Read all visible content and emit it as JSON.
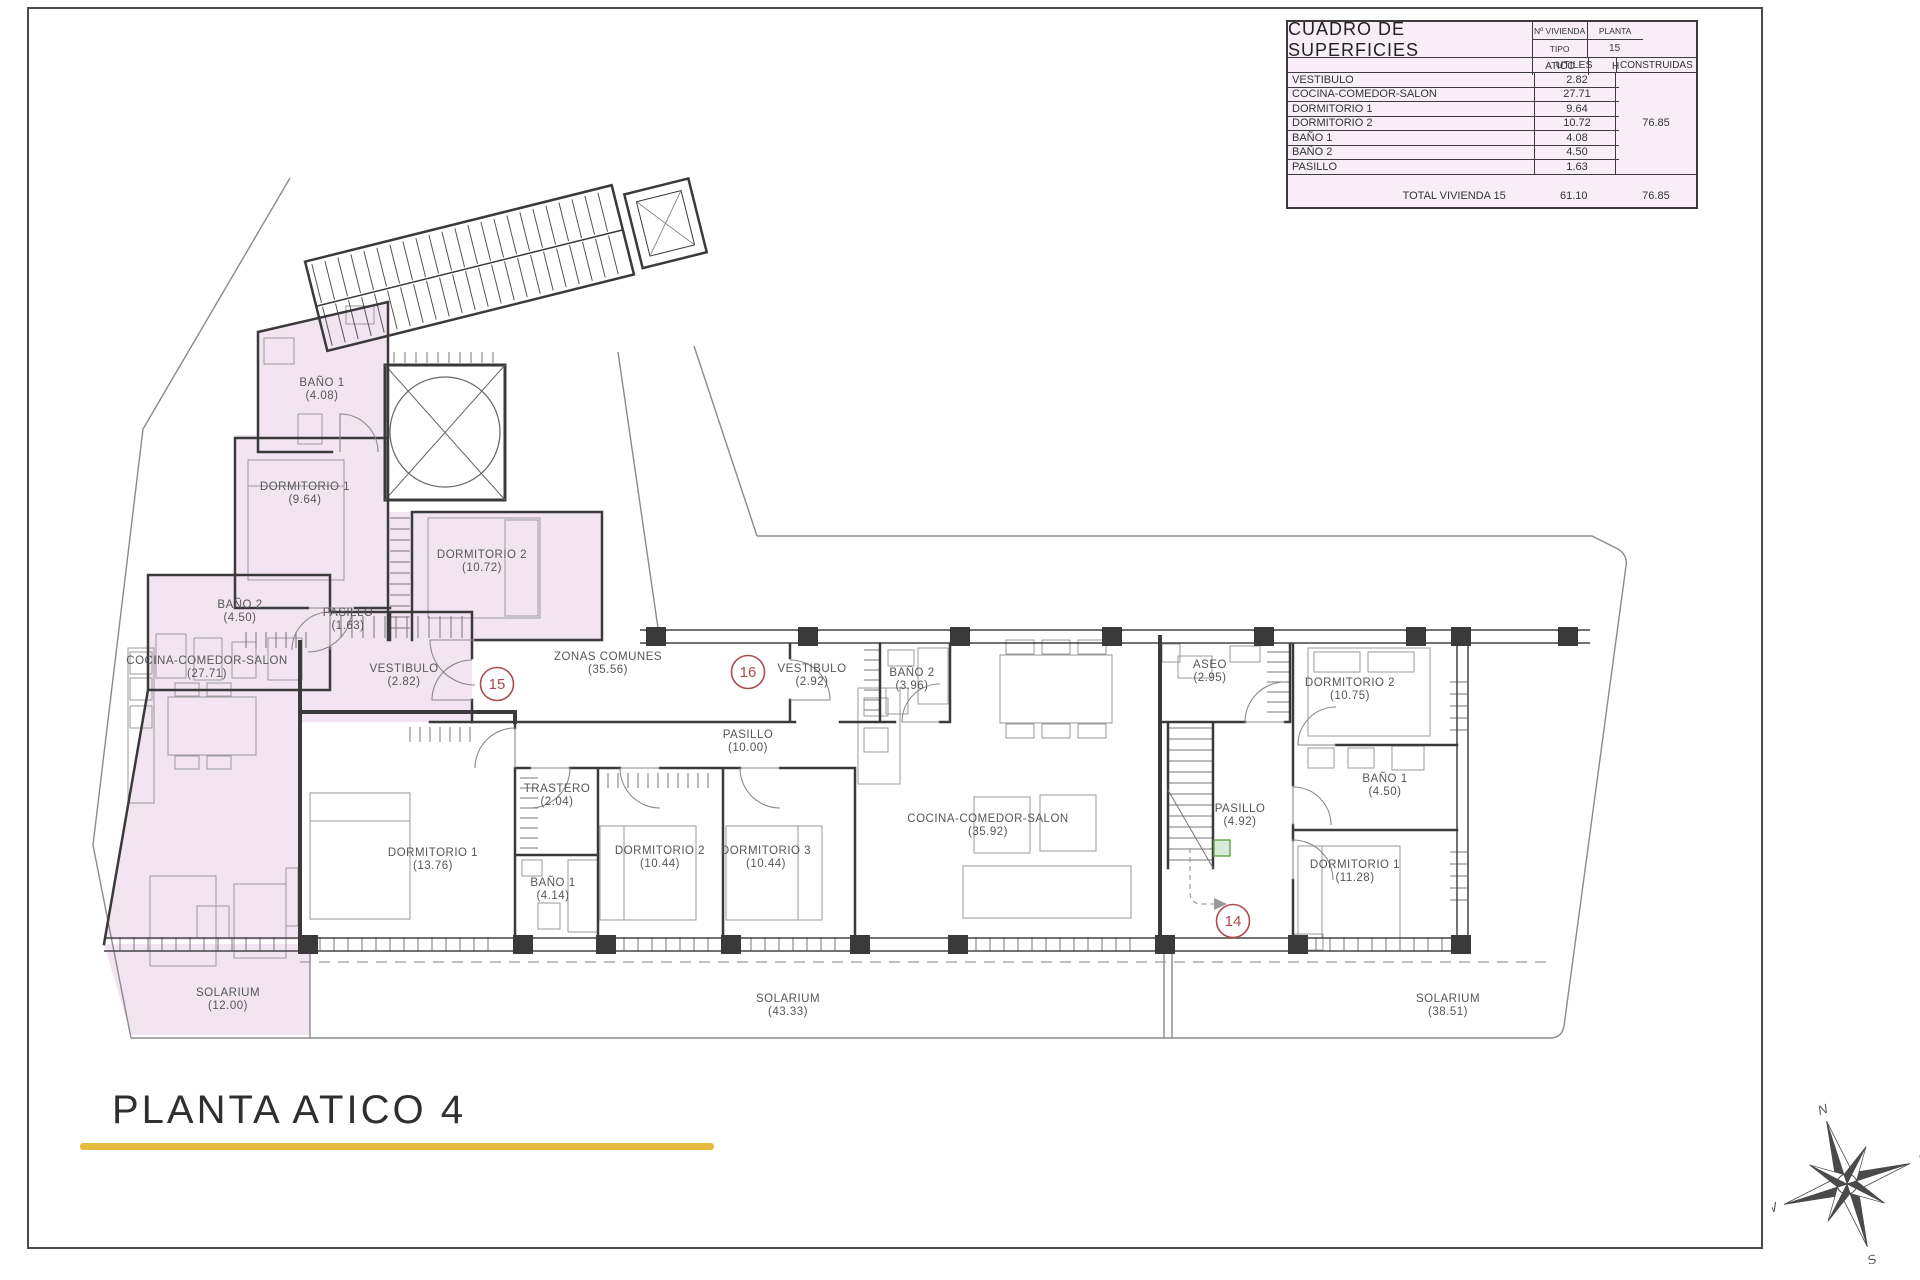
{
  "page": {
    "title": "PLANTA ATICO 4"
  },
  "table": {
    "title": "CUADRO DE SUPERFICIES",
    "header": {
      "col1": "Nº VIVIENDA",
      "col2": "PLANTA",
      "col3": "TIPO",
      "val1": "15",
      "val2": "ATICO",
      "val3": "H"
    },
    "subheader": {
      "utiles": "UTILES",
      "construidas": "CONSTRUIDAS"
    },
    "rows": [
      {
        "label": "VESTIBULO",
        "utiles": "2.82"
      },
      {
        "label": "COCINA-COMEDOR-SALON",
        "utiles": "27.71"
      },
      {
        "label": "DORMITORIO 1",
        "utiles": "9.64"
      },
      {
        "label": "DORMITORIO 2",
        "utiles": "10.72"
      },
      {
        "label": "BAÑO 1",
        "utiles": "4.08"
      },
      {
        "label": "BAÑO 2",
        "utiles": "4.50"
      },
      {
        "label": "PASILLO",
        "utiles": "1.63"
      }
    ],
    "construidas_total": "76.85",
    "total": {
      "label": "TOTAL VIVIENDA 15",
      "utiles": "61.10",
      "construidas": "76.85"
    }
  },
  "plan": {
    "rooms": [
      {
        "id": "bano1_15",
        "name": "BAÑO 1",
        "area": "(4.08)"
      },
      {
        "id": "dorm1_15",
        "name": "DORMITORIO 1",
        "area": "(9.64)"
      },
      {
        "id": "dorm2_15",
        "name": "DORMITORIO 2",
        "area": "(10.72)"
      },
      {
        "id": "bano2_15",
        "name": "BAÑO 2",
        "area": "(4.50)"
      },
      {
        "id": "pasillo_15",
        "name": "PASILLO",
        "area": "(1.63)"
      },
      {
        "id": "vest_15",
        "name": "VESTIBULO",
        "area": "(2.82)"
      },
      {
        "id": "cocina_15",
        "name": "COCINA-COMEDOR-SALON",
        "area": "(27.71)"
      },
      {
        "id": "solarium_15",
        "name": "SOLARIUM",
        "area": "(12.00)"
      },
      {
        "id": "zonas",
        "name": "ZONAS COMUNES",
        "area": "(35.56)"
      },
      {
        "id": "vest_16",
        "name": "VESTIBULO",
        "area": "(2.92)"
      },
      {
        "id": "bano2_16",
        "name": "BAÑO 2",
        "area": "(3.96)"
      },
      {
        "id": "pasillo_16",
        "name": "PASILLO",
        "area": "(10.00)"
      },
      {
        "id": "trastero",
        "name": "TRASTERO",
        "area": "(2.04)"
      },
      {
        "id": "dorm1_16",
        "name": "DORMITORIO 1",
        "area": "(13.76)"
      },
      {
        "id": "bano1_16",
        "name": "BAÑO 1",
        "area": "(4.14)"
      },
      {
        "id": "dorm2_16",
        "name": "DORMITORIO 2",
        "area": "(10.44)"
      },
      {
        "id": "dorm3_16",
        "name": "DORMITORIO 3",
        "area": "(10.44)"
      },
      {
        "id": "cocina_16",
        "name": "COCINA-COMEDOR-SALON",
        "area": "(35.92)"
      },
      {
        "id": "solarium_16",
        "name": "SOLARIUM",
        "area": "(43.33)"
      },
      {
        "id": "aseo_14",
        "name": "ASEO",
        "area": "(2.95)"
      },
      {
        "id": "dorm2_14",
        "name": "DORMITORIO 2",
        "area": "(10.75)"
      },
      {
        "id": "bano1_14",
        "name": "BAÑO 1",
        "area": "(4.50)"
      },
      {
        "id": "pasillo_14",
        "name": "PASILLO",
        "area": "(4.92)"
      },
      {
        "id": "dorm1_14",
        "name": "DORMITORIO 1",
        "area": "(11.28)"
      },
      {
        "id": "solarium_14",
        "name": "SOLARIUM",
        "area": "(38.51)"
      }
    ],
    "units": [
      {
        "id": "u15",
        "number": "15"
      },
      {
        "id": "u16",
        "number": "16"
      },
      {
        "id": "u14",
        "number": "14"
      }
    ]
  },
  "compass": {
    "n": "N",
    "e": "E",
    "s": "S",
    "w": "W"
  },
  "colors": {
    "apartment_fill": "#f2e4f1",
    "table_bg": "#f9eef7",
    "unit_badge": "#b0494f",
    "underline": "#e6b93f",
    "wall": "#3a3a3a",
    "highlight_green": "#6aa84f"
  }
}
